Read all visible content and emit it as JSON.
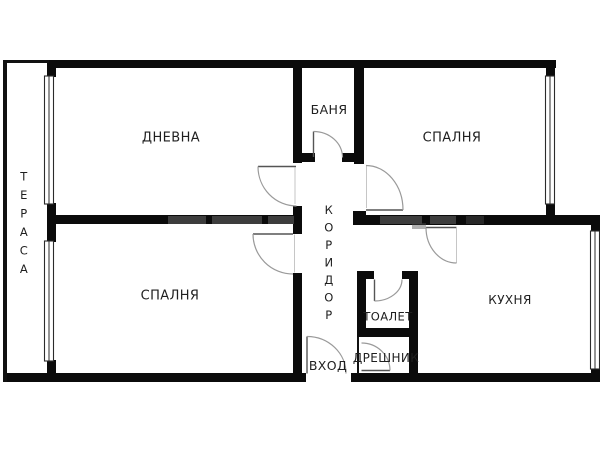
{
  "floor_plan": {
    "rooms": {
      "terrace": "ТЕРАСА",
      "living_room": "ДНЕВНА",
      "bathroom": "БАНЯ",
      "bedroom_top": "СПАЛНЯ",
      "corridor": "КОРИДОР",
      "bedroom_bottom": "СПАЛНЯ",
      "toilet": "ТОАЛЕТ",
      "closet": "ДРЕШНИК",
      "entrance": "ВХОД",
      "kitchen": "КУХНЯ"
    },
    "colors": {
      "wall": "#0b0b0b",
      "door_arc": "#9a9a9a",
      "door_leaf": "#555555",
      "window_outline": "#2b2b2b",
      "text": "#1f1f1f",
      "background": "#ffffff"
    }
  }
}
